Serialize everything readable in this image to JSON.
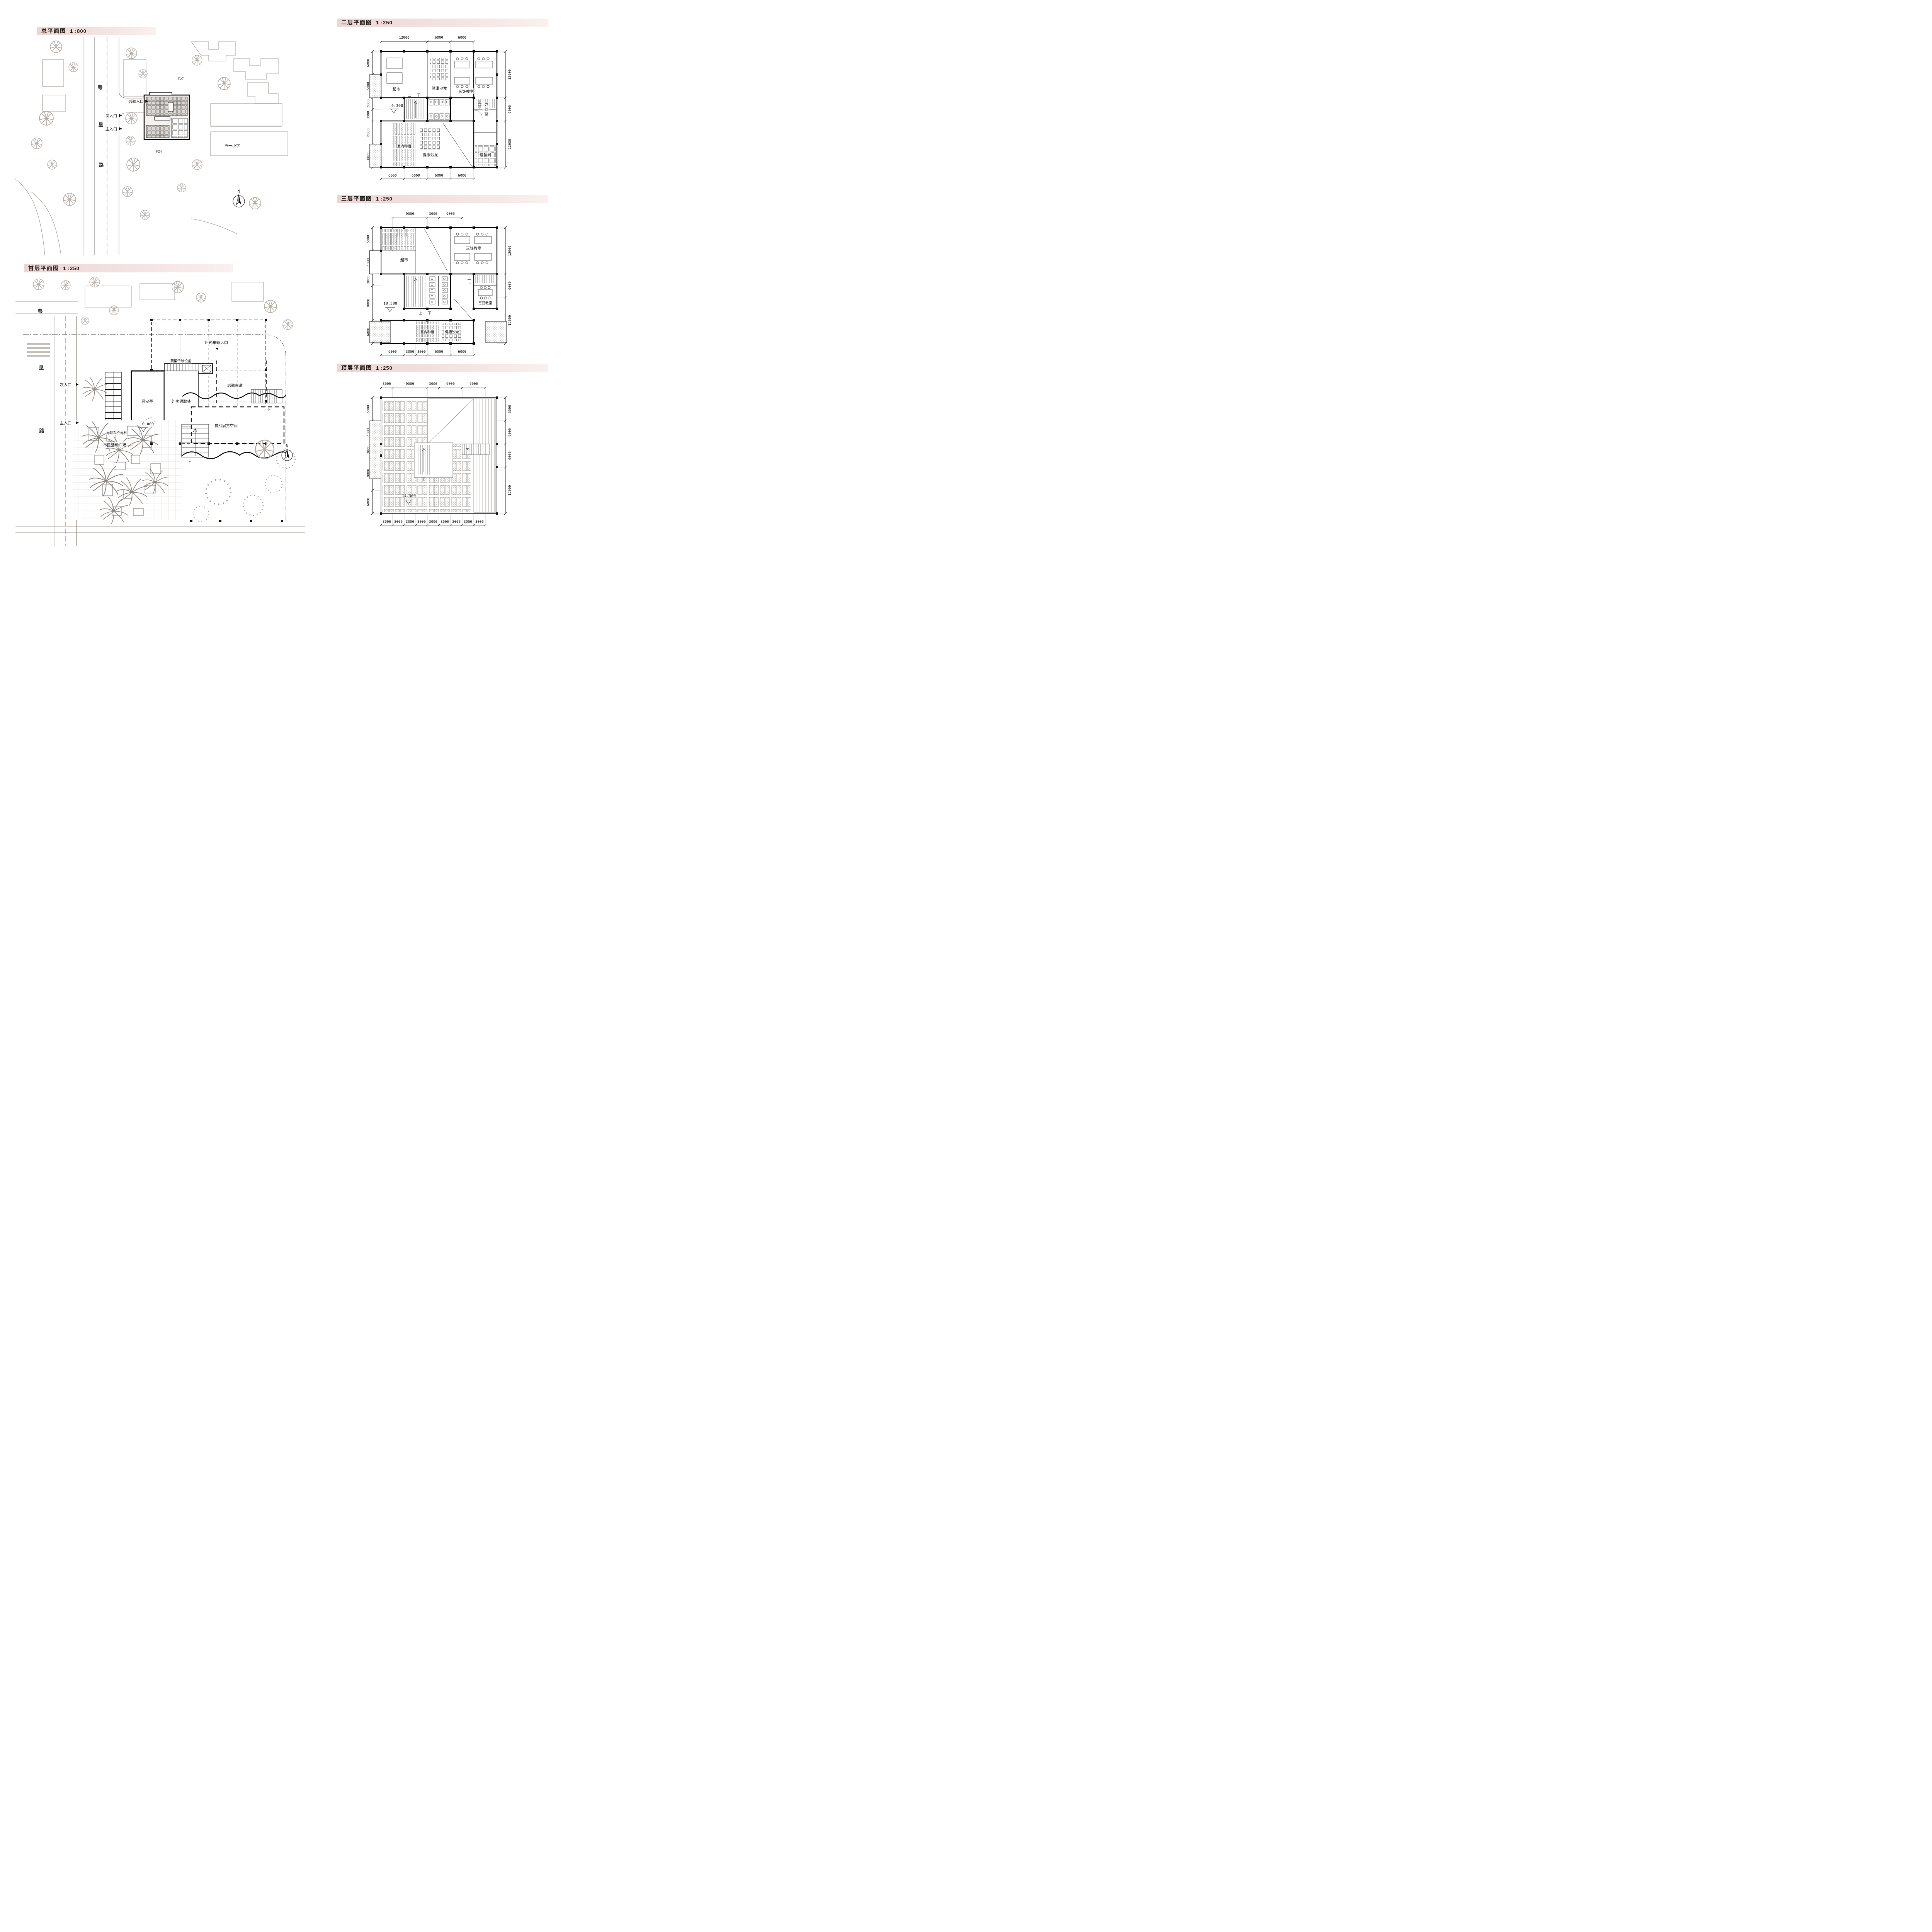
{
  "common": {
    "up": "上",
    "down": "下",
    "north": "N",
    "icons": {
      "arrow_right": "▶",
      "arrow_down": "▼"
    }
  },
  "panels": {
    "site": {
      "title": "总平面图",
      "scale": "1 :800",
      "road_name": [
        "粤",
        "垦",
        "路"
      ],
      "labels": {
        "entry_service": "后勤入口",
        "entry_secondary": "次入口",
        "entry_main": "主入口",
        "school": "五一小学",
        "bldg_f27": "F27",
        "bldg_f24": "F24"
      }
    },
    "floor1": {
      "title": "首层平面图",
      "scale": "1 :250",
      "road_name": [
        "粤",
        "垦",
        "路"
      ],
      "labels": {
        "entry_service_vehicle": "后勤车辆入口",
        "veg_conveyor": "蔬菜传输设备",
        "guard_booth": "保安亭",
        "takeout_pickup": "外卖领取处",
        "service_lane": "后勤车道",
        "ev_charging": "电动车充电桩",
        "entry_secondary": "次入口",
        "entry_main": "主入口",
        "civic_plaza": "市民活动广场",
        "nature_exhibit": "自然展览空间",
        "level": "0.000"
      }
    },
    "floor2": {
      "title": "二层平面图",
      "scale": "1 :250",
      "level": "6.300",
      "rooms": {
        "health_salon_top": "健康沙龙",
        "market": "超市",
        "cooking": "烹饪教室",
        "office": "办公室",
        "indoor_planting": "室内种植",
        "health_salon_bottom": "健康沙龙",
        "equipment": "设备间"
      },
      "dims_top": [
        "12000",
        "6000",
        "6000"
      ],
      "dims_left": [
        "6000",
        "6000",
        "3000",
        "3000",
        "6000",
        "6000"
      ],
      "dims_right": [
        "12000",
        "6000",
        "12000"
      ],
      "dims_bottom": [
        "6000",
        "6000",
        "6000",
        "6000"
      ]
    },
    "floor3": {
      "title": "三层平面图",
      "scale": "1 :250",
      "level": "10.300",
      "rooms": {
        "market": "超市",
        "cooking_top": "烹饪教室",
        "cooking_small": "烹饪教室",
        "indoor_planting": "室内种植",
        "health_salon": "健康沙龙"
      },
      "dims_top": [
        "9000",
        "3000",
        "6000"
      ],
      "dims_left": [
        "6000",
        "6000",
        "3000",
        "9000",
        "6000"
      ],
      "dims_right": [
        "12000",
        "6000",
        "12000"
      ],
      "dims_bottom": [
        "6000",
        "3000",
        "3000",
        "6000",
        "6000"
      ]
    },
    "floor_top": {
      "title": "顶层平面图",
      "scale": "1 :250",
      "level": "14.300",
      "dims_top": [
        "3000",
        "9000",
        "3000",
        "6000",
        "6000"
      ],
      "dims_left": [
        "6000",
        "6000",
        "3000",
        "9000",
        "6000"
      ],
      "dims_right": [
        "6000",
        "6000",
        "6000",
        "12000"
      ],
      "dims_bottom": [
        "3000",
        "3000",
        "3000",
        "3000",
        "3000",
        "3000",
        "3000",
        "3000",
        "3000"
      ]
    }
  }
}
